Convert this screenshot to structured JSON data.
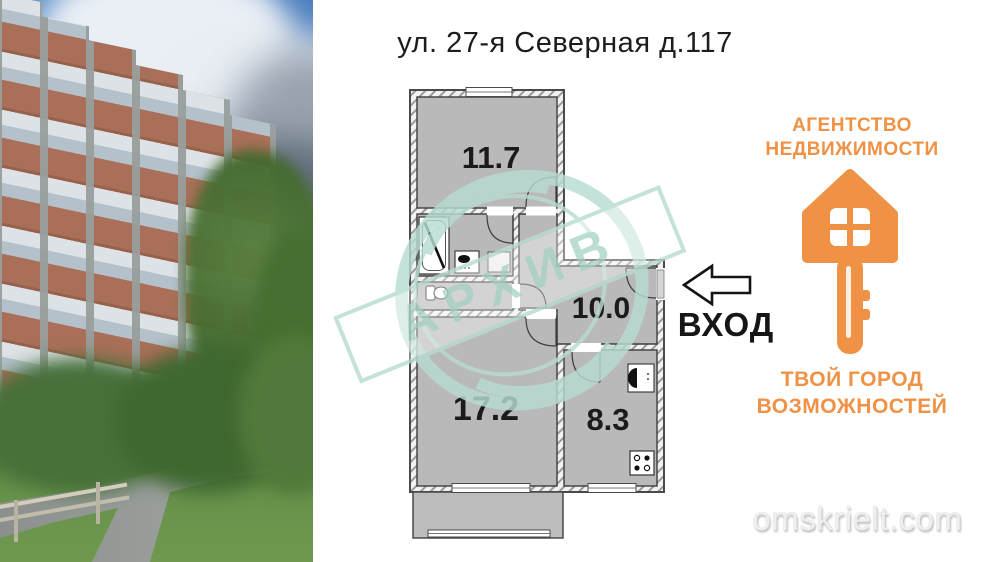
{
  "title": "ул. 27-я Северная д.117",
  "floor_plan": {
    "watermark_stamp": "АРХИВ",
    "entrance_label": "ВХОД",
    "rooms": [
      {
        "name": "living-room",
        "area": "11.7"
      },
      {
        "name": "hallway",
        "area": "10.0"
      },
      {
        "name": "bedroom",
        "area": "17.2"
      },
      {
        "name": "kitchen",
        "area": "8.3"
      }
    ]
  },
  "agency": {
    "title_line1": "АГЕНТСТВО",
    "title_line2": "НЕДВИЖИМОСТИ",
    "slogan_line1": "ТВОЙ ГОРОД",
    "slogan_line2": "ВОЗМОЖНОСТЕЙ"
  },
  "site_watermark": "omskrielt.com",
  "colors": {
    "accent_orange": "#ef9245",
    "stamp_mint": "#b7dcd1",
    "room_fill": "#b9b9b9"
  }
}
